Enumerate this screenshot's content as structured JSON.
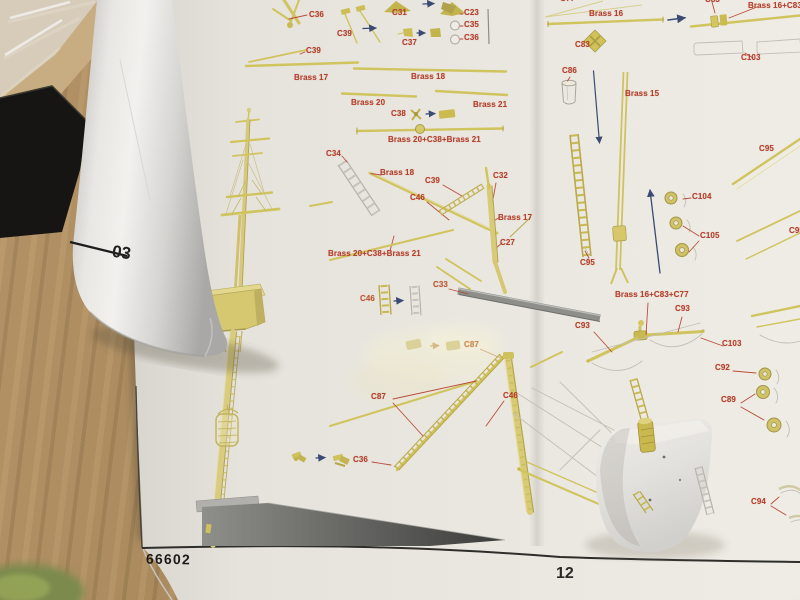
{
  "sheet": {
    "kit_number": "66602",
    "page_number": "12",
    "adjacent_sheet_text": "03"
  },
  "colors": {
    "label_red": "#b6402c",
    "label_orange": "#c8803e",
    "brass": "#d2c462",
    "arrow_blue": "#3a4a72",
    "page": "#e9e6df",
    "wood": "#a5865a"
  },
  "labels": [
    {
      "text": "C36",
      "x": 309,
      "y": 11
    },
    {
      "text": "C31",
      "x": 392,
      "y": 9
    },
    {
      "text": "C39",
      "x": 337,
      "y": 30
    },
    {
      "text": "C37",
      "x": 402,
      "y": 39
    },
    {
      "text": "C23",
      "x": 464,
      "y": 9
    },
    {
      "text": "C35",
      "x": 464,
      "y": 21
    },
    {
      "text": "C36",
      "x": 464,
      "y": 34
    },
    {
      "text": "C39",
      "x": 306,
      "y": 47
    },
    {
      "text": "Brass 17",
      "x": 294,
      "y": 74
    },
    {
      "text": "Brass 18",
      "x": 411,
      "y": 73
    },
    {
      "text": "Brass 20",
      "x": 351,
      "y": 99
    },
    {
      "text": "Brass 21",
      "x": 473,
      "y": 101
    },
    {
      "text": "C38",
      "x": 391,
      "y": 110
    },
    {
      "text": "Brass 20+C38+Brass 21",
      "x": 388,
      "y": 136
    },
    {
      "text": "C34",
      "x": 326,
      "y": 150
    },
    {
      "text": "Brass 18",
      "x": 380,
      "y": 169
    },
    {
      "text": "C39",
      "x": 425,
      "y": 177
    },
    {
      "text": "C32",
      "x": 493,
      "y": 172
    },
    {
      "text": "C46",
      "x": 410,
      "y": 194
    },
    {
      "text": "Brass 17",
      "x": 498,
      "y": 214
    },
    {
      "text": "C27",
      "x": 500,
      "y": 239
    },
    {
      "text": "Brass 20+C38+Brass 21",
      "x": 328,
      "y": 250
    },
    {
      "text": "C46",
      "x": 360,
      "y": 295,
      "color": "#c05a30"
    },
    {
      "text": "C33",
      "x": 433,
      "y": 281,
      "color": "#c05a30"
    },
    {
      "text": "C87",
      "x": 464,
      "y": 341,
      "color": "#cf8d4f"
    },
    {
      "text": "C87",
      "x": 371,
      "y": 393
    },
    {
      "text": "C46",
      "x": 503,
      "y": 392
    },
    {
      "text": "C36",
      "x": 353,
      "y": 456
    },
    {
      "text": "C77",
      "x": 560,
      "y": -5
    },
    {
      "text": "Brass 16",
      "x": 589,
      "y": 10
    },
    {
      "text": "C83",
      "x": 705,
      "y": -4
    },
    {
      "text": "Brass 16+C83+C77",
      "x": 748,
      "y": 2
    },
    {
      "text": "C103",
      "x": 741,
      "y": 54
    },
    {
      "text": "C83",
      "x": 575,
      "y": 41
    },
    {
      "text": "C86",
      "x": 562,
      "y": 67
    },
    {
      "text": "Brass 15",
      "x": 625,
      "y": 90
    },
    {
      "text": "C95",
      "x": 580,
      "y": 259
    },
    {
      "text": "C104",
      "x": 692,
      "y": 193
    },
    {
      "text": "C105",
      "x": 700,
      "y": 232
    },
    {
      "text": "C95",
      "x": 759,
      "y": 145
    },
    {
      "text": "C95",
      "x": 789,
      "y": 227
    },
    {
      "text": "Brass 16+C83+C77",
      "x": 615,
      "y": 291
    },
    {
      "text": "C93",
      "x": 675,
      "y": 305
    },
    {
      "text": "C93",
      "x": 575,
      "y": 322
    },
    {
      "text": "C103",
      "x": 722,
      "y": 340
    },
    {
      "text": "C92",
      "x": 715,
      "y": 364
    },
    {
      "text": "C89",
      "x": 721,
      "y": 396
    },
    {
      "text": "C94",
      "x": 751,
      "y": 498
    }
  ]
}
